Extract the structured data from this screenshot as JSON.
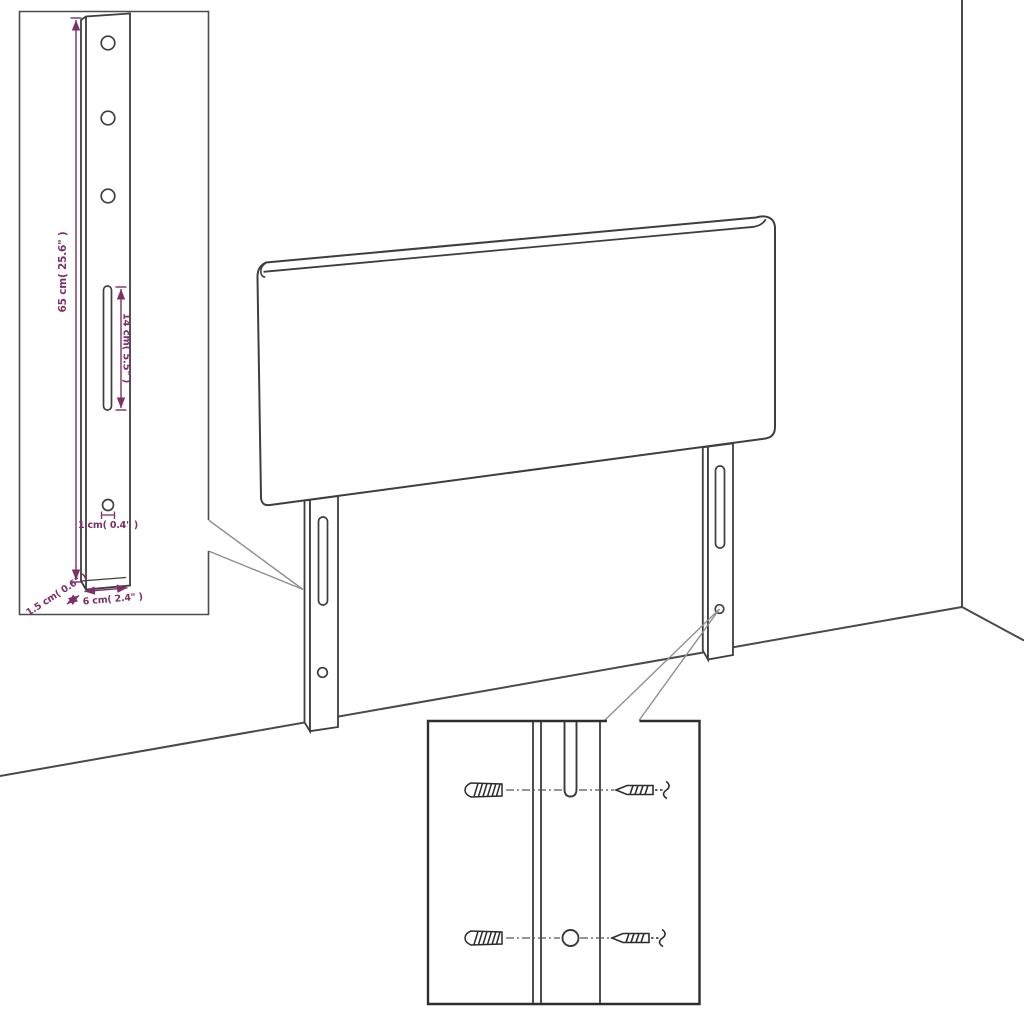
{
  "diagram": {
    "kind": "furniture-assembly-measurement-diagram",
    "subject": "wall-mounted headboard with two mounting legs",
    "colors": {
      "dimension": "#7d2f68",
      "outline": "#3e3e3e",
      "leader": "#8f8f8f",
      "inset_border": "#2e2e2e",
      "background": "#ffffff"
    },
    "dimensions": {
      "bracket_height_label": "65 cm( 25.6\" )",
      "slot_length_label": "14 cm( 5.5\" )",
      "hole_diameter_label": "1 cm( 0.4\" )",
      "bracket_depth_label": "1.5 cm( 0.6\" )",
      "bracket_width_label": "6 cm( 2.4\" )"
    },
    "insets": {
      "bracket_detail": {
        "holes_top": 3,
        "slot_count": 1,
        "hole_bottom": 1
      },
      "mounting_detail": {
        "wall_plugs": 2,
        "screws": 2,
        "connector_style": "dash-dot"
      }
    },
    "scene": {
      "legs": 2,
      "slots_per_leg": 1,
      "holes_per_leg": 1,
      "wall_corner": true
    }
  }
}
